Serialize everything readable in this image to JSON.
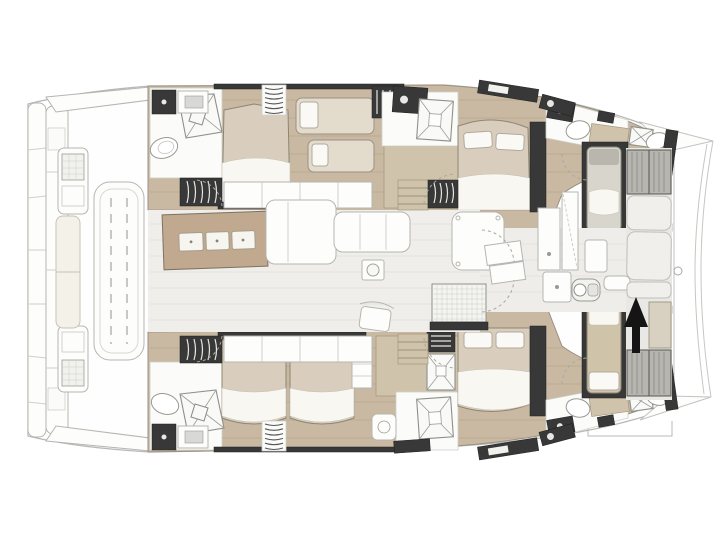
{
  "diagram": {
    "type": "yacht-floor-plan",
    "subject": "Catamaran interior deck plan, top-down view",
    "bow_direction": "right",
    "stern_direction": "left",
    "direction_arrow": {
      "glyph": "▲",
      "points": "up"
    }
  },
  "palette": {
    "background": "#ffffff",
    "line": "#b9b9b9",
    "line2": "#b5b5b0",
    "dark": "#383838",
    "wood": "#c9b9a2",
    "wood_mid": "#d0c3ab",
    "wood_line": "#ab997d",
    "mattress": "#d9cebd",
    "linen": "#f8f7f2",
    "island": "#c0a98f",
    "sunpad": "#b6b5b0",
    "floor": "#f0eeea",
    "floor_line": "#e5e3de",
    "bow_deck": "#eae8e4",
    "arrow": "#151515"
  },
  "inventory": {
    "double_beds": 5,
    "single_berths": 4,
    "bathrooms": 6,
    "showers": 6,
    "toilets": 6,
    "galley_island_stools": 3,
    "cockpit_table": 1,
    "aft_bench": 1,
    "bow_sunpads": 2
  }
}
